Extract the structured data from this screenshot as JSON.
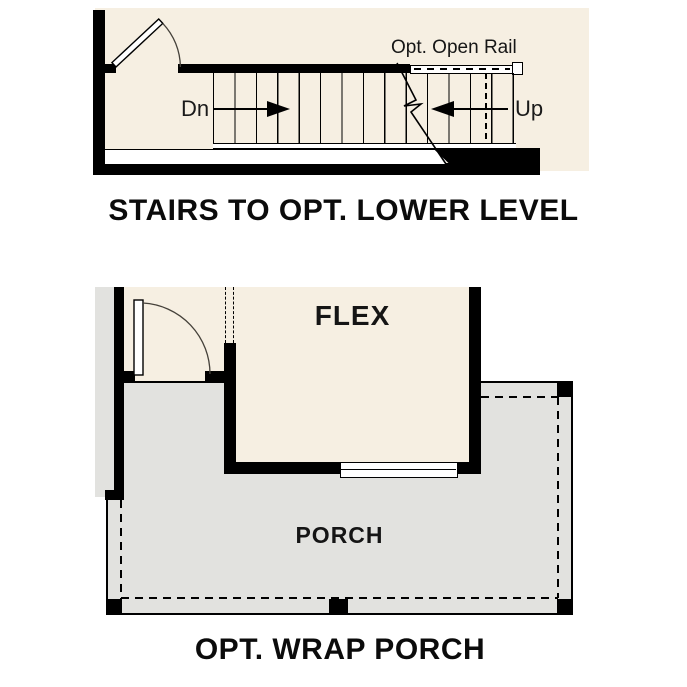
{
  "colors": {
    "floor_cream": "#f6efe2",
    "porch_gray": "#e2e2df",
    "wall_black": "#000000",
    "background": "#ffffff"
  },
  "stairs_diagram": {
    "caption": "STAIRS TO OPT. LOWER LEVEL",
    "open_rail_label": "Opt. Open Rail",
    "down_label": "Dn",
    "up_label": "Up"
  },
  "porch_diagram": {
    "caption": "OPT. WRAP PORCH",
    "flex_room_label": "FLEX",
    "porch_label": "PORCH"
  }
}
